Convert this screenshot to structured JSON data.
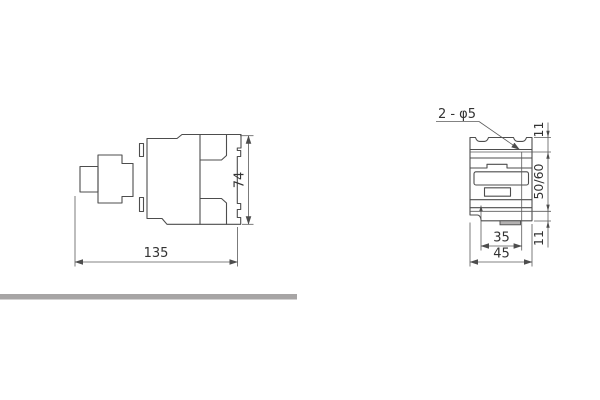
{
  "drawing": {
    "side_view": {
      "width_dim": "135",
      "height_dim": "74"
    },
    "front_view": {
      "holes_label": "2 - φ5",
      "top_offset_dim": "11",
      "vertical_spacing_dim": "50/60",
      "bottom_offset_dim": "11",
      "hole_spacing_dim": "35",
      "width_dim": "45"
    },
    "colors": {
      "line": "#4d4d4d",
      "text": "#333333",
      "divider_bar": "#a7a5a5"
    }
  }
}
